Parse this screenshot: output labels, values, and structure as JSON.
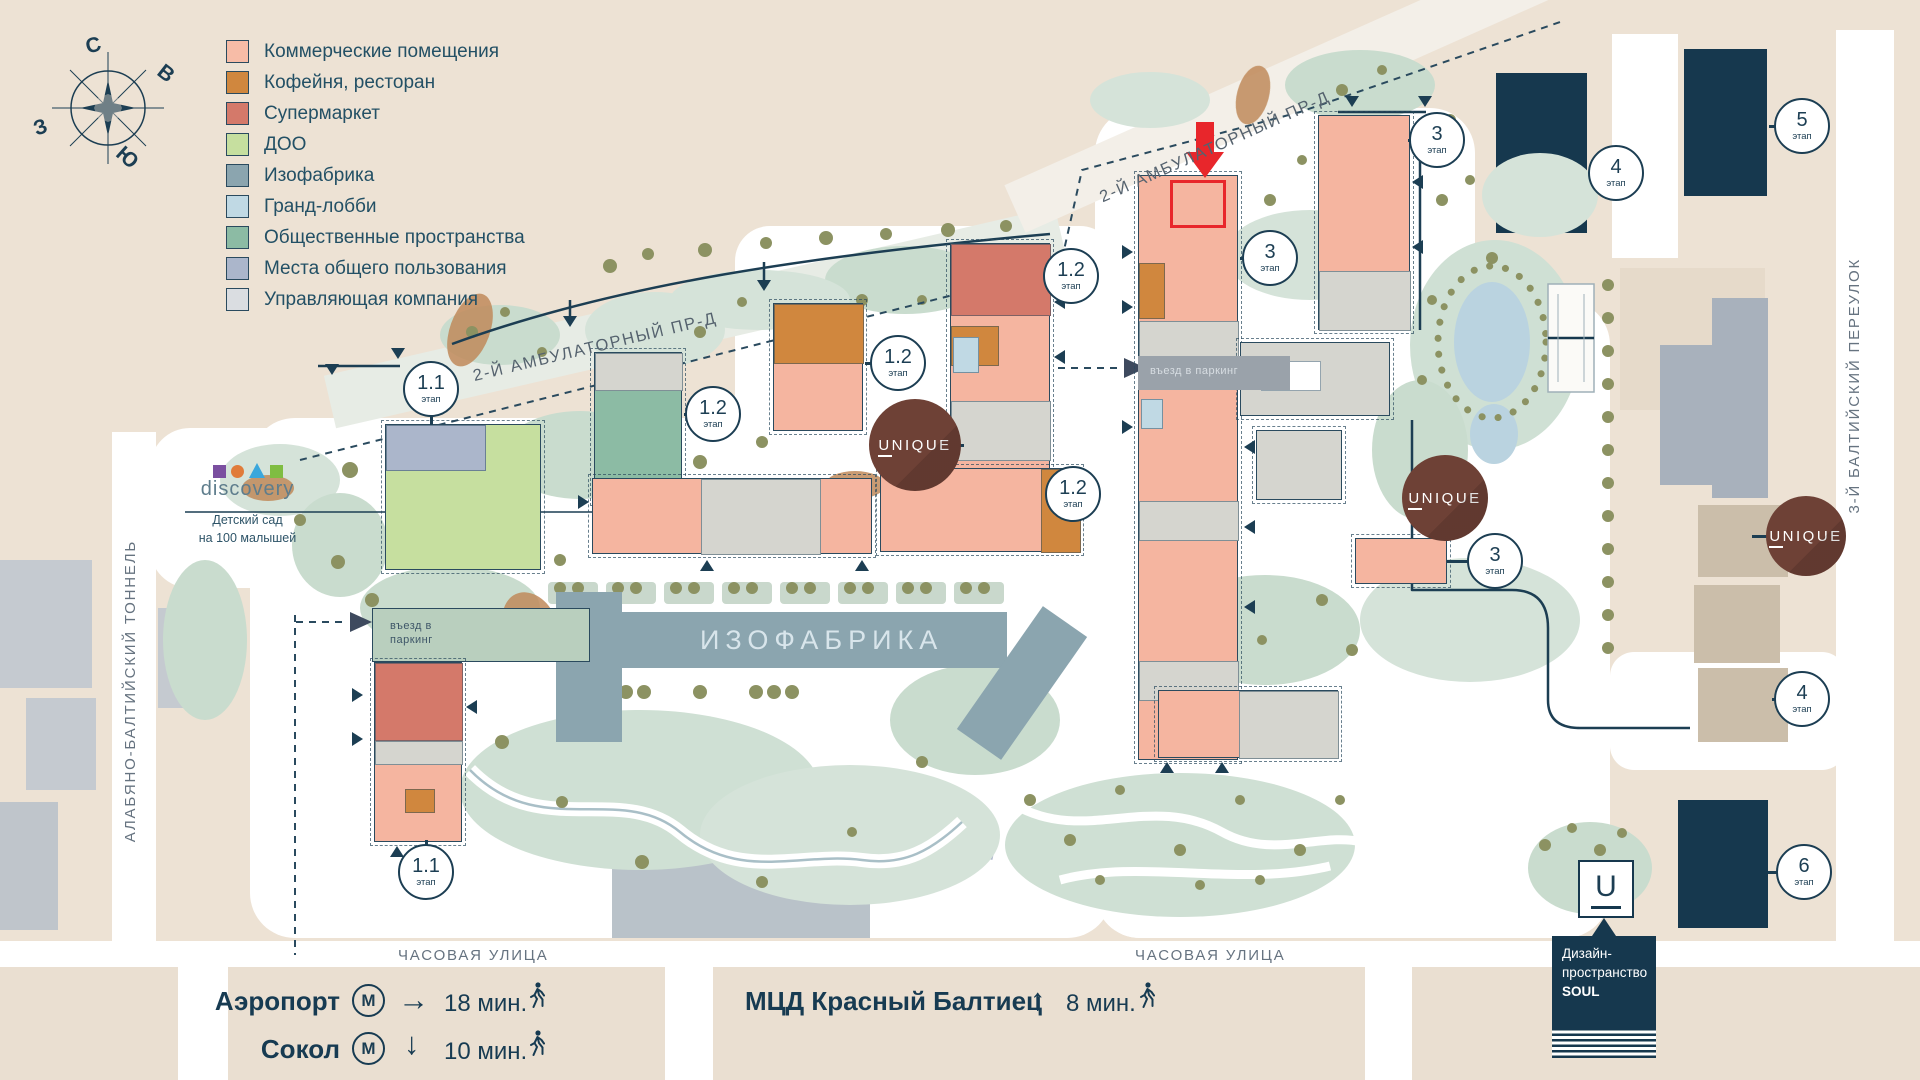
{
  "compass": {
    "n": "С",
    "e": "В",
    "w": "З",
    "s": "Ю"
  },
  "legend": {
    "items": [
      {
        "label": "Коммерческие помещения",
        "color": "#F7BCA7"
      },
      {
        "label": "Кофейня, ресторан",
        "color": "#D0873E"
      },
      {
        "label": "Супермаркет",
        "color": "#D4796A"
      },
      {
        "label": "ДОО",
        "color": "#C6DF9F"
      },
      {
        "label": "Изофабрика",
        "color": "#8BA5AF"
      },
      {
        "label": "Гранд-лобби",
        "color": "#C0D9E4"
      },
      {
        "label": "Общественные пространства",
        "color": "#8CBBA4"
      },
      {
        "label": "Места общего пользования",
        "color": "#ABB6CB"
      },
      {
        "label": "Управляющая компания",
        "color": "#DADDE1"
      }
    ]
  },
  "streets": {
    "tunnel": "АЛАБЯНО-БАЛТИЙСКИЙ ТОННЕЛЬ",
    "ambulatorny": "2-Й АМБУЛАТОРНЫЙ ПР-Д",
    "ambulatorny_top": "2-Й АМБУЛАТОРНЫЙ ПР-Д",
    "baltiysky": "3-Й БАЛТИЙСКИЙ ПЕРЕУЛОК",
    "chasovaya": "ЧАСОВАЯ УЛИЦА"
  },
  "stages": [
    {
      "num": "1.1",
      "sub": "этап"
    },
    {
      "num": "1.2",
      "sub": "этап"
    },
    {
      "num": "1.2",
      "sub": "этап"
    },
    {
      "num": "1.2",
      "sub": "этап"
    },
    {
      "num": "1.2",
      "sub": "этап"
    },
    {
      "num": "1.1",
      "sub": "этап"
    },
    {
      "num": "3",
      "sub": "этап"
    },
    {
      "num": "3",
      "sub": "этап"
    },
    {
      "num": "3",
      "sub": "этап"
    },
    {
      "num": "4",
      "sub": "этап"
    },
    {
      "num": "5",
      "sub": "этап"
    },
    {
      "num": "4",
      "sub": "этап"
    },
    {
      "num": "6",
      "sub": "этап"
    }
  ],
  "badges": {
    "unique": "UNIQUE",
    "unique_first_letter": "U",
    "unique_rest": "NIQUE"
  },
  "labels": {
    "izofabrika": "ИЗОФАБРИКА",
    "parking": "въезд в паркинг"
  },
  "kindergarten": {
    "brand": "discovery",
    "line1": "Детский сад",
    "line2": "на 100 малышей"
  },
  "soul": {
    "letter": "U",
    "line1": "Дизайн-",
    "line2": "пространство",
    "line3": "SOUL"
  },
  "transit": {
    "airport": {
      "name": "Аэропорт",
      "metro": "М",
      "arrow": "→",
      "time": "18 мин."
    },
    "sokol": {
      "name": "Сокол",
      "metro": "М",
      "arrow": "↓",
      "time": "10 мин."
    },
    "mcd": {
      "name": "МЦД Красный Балтиец",
      "arrow": "↑",
      "time": "8 мин."
    }
  },
  "colors": {
    "background": "#EDE2D4",
    "navy": "#1C3E53",
    "dark_building": "#16384E",
    "salmon": "#F5B5A0",
    "orange": "#D0873E",
    "red_marker": "#E8262B",
    "unique_brown": "#6E4136",
    "pool_blue": "#BAD3E0",
    "sage": "#D5E3D9",
    "olive_tree": "#8C9262",
    "izofabrika_slate": "#8BA5AF"
  }
}
